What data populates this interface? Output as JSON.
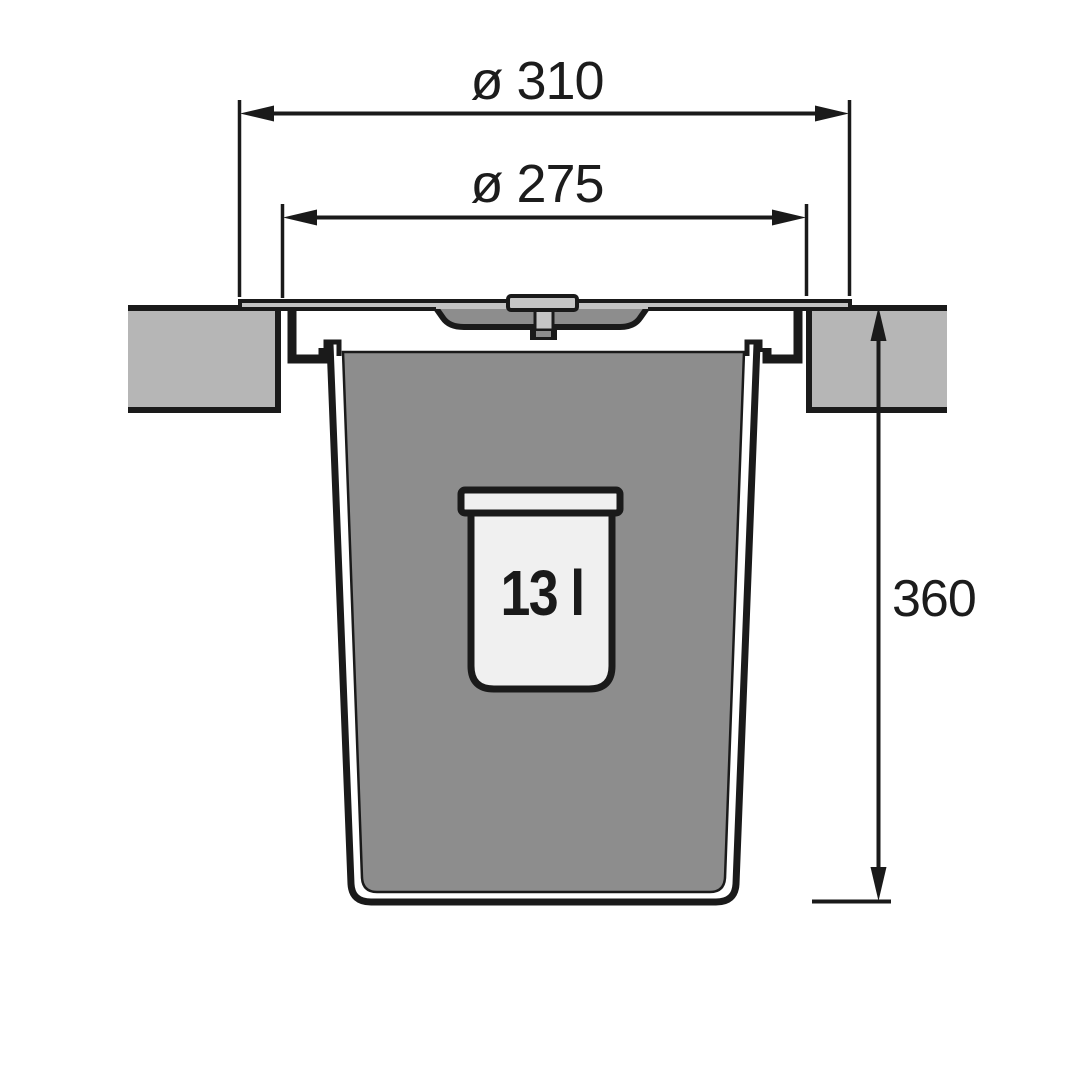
{
  "drawing": {
    "kind": "built-in waste bin cross-section",
    "dimensions": {
      "outer_diameter_label": "ø 310",
      "inset_diameter_label": "ø 275",
      "depth_label": "360"
    },
    "bin": {
      "capacity_label": "13 l"
    },
    "colors": {
      "outline": "#1a1a1a",
      "countertop": "#b6b6b6",
      "bin": "#8d8d8d",
      "lid": "#c3c3c3",
      "handle": "#c6c6c6",
      "bucket": "#f0f0f0",
      "dimension_text": "#1c1c1c",
      "background": "#ffffff"
    }
  }
}
